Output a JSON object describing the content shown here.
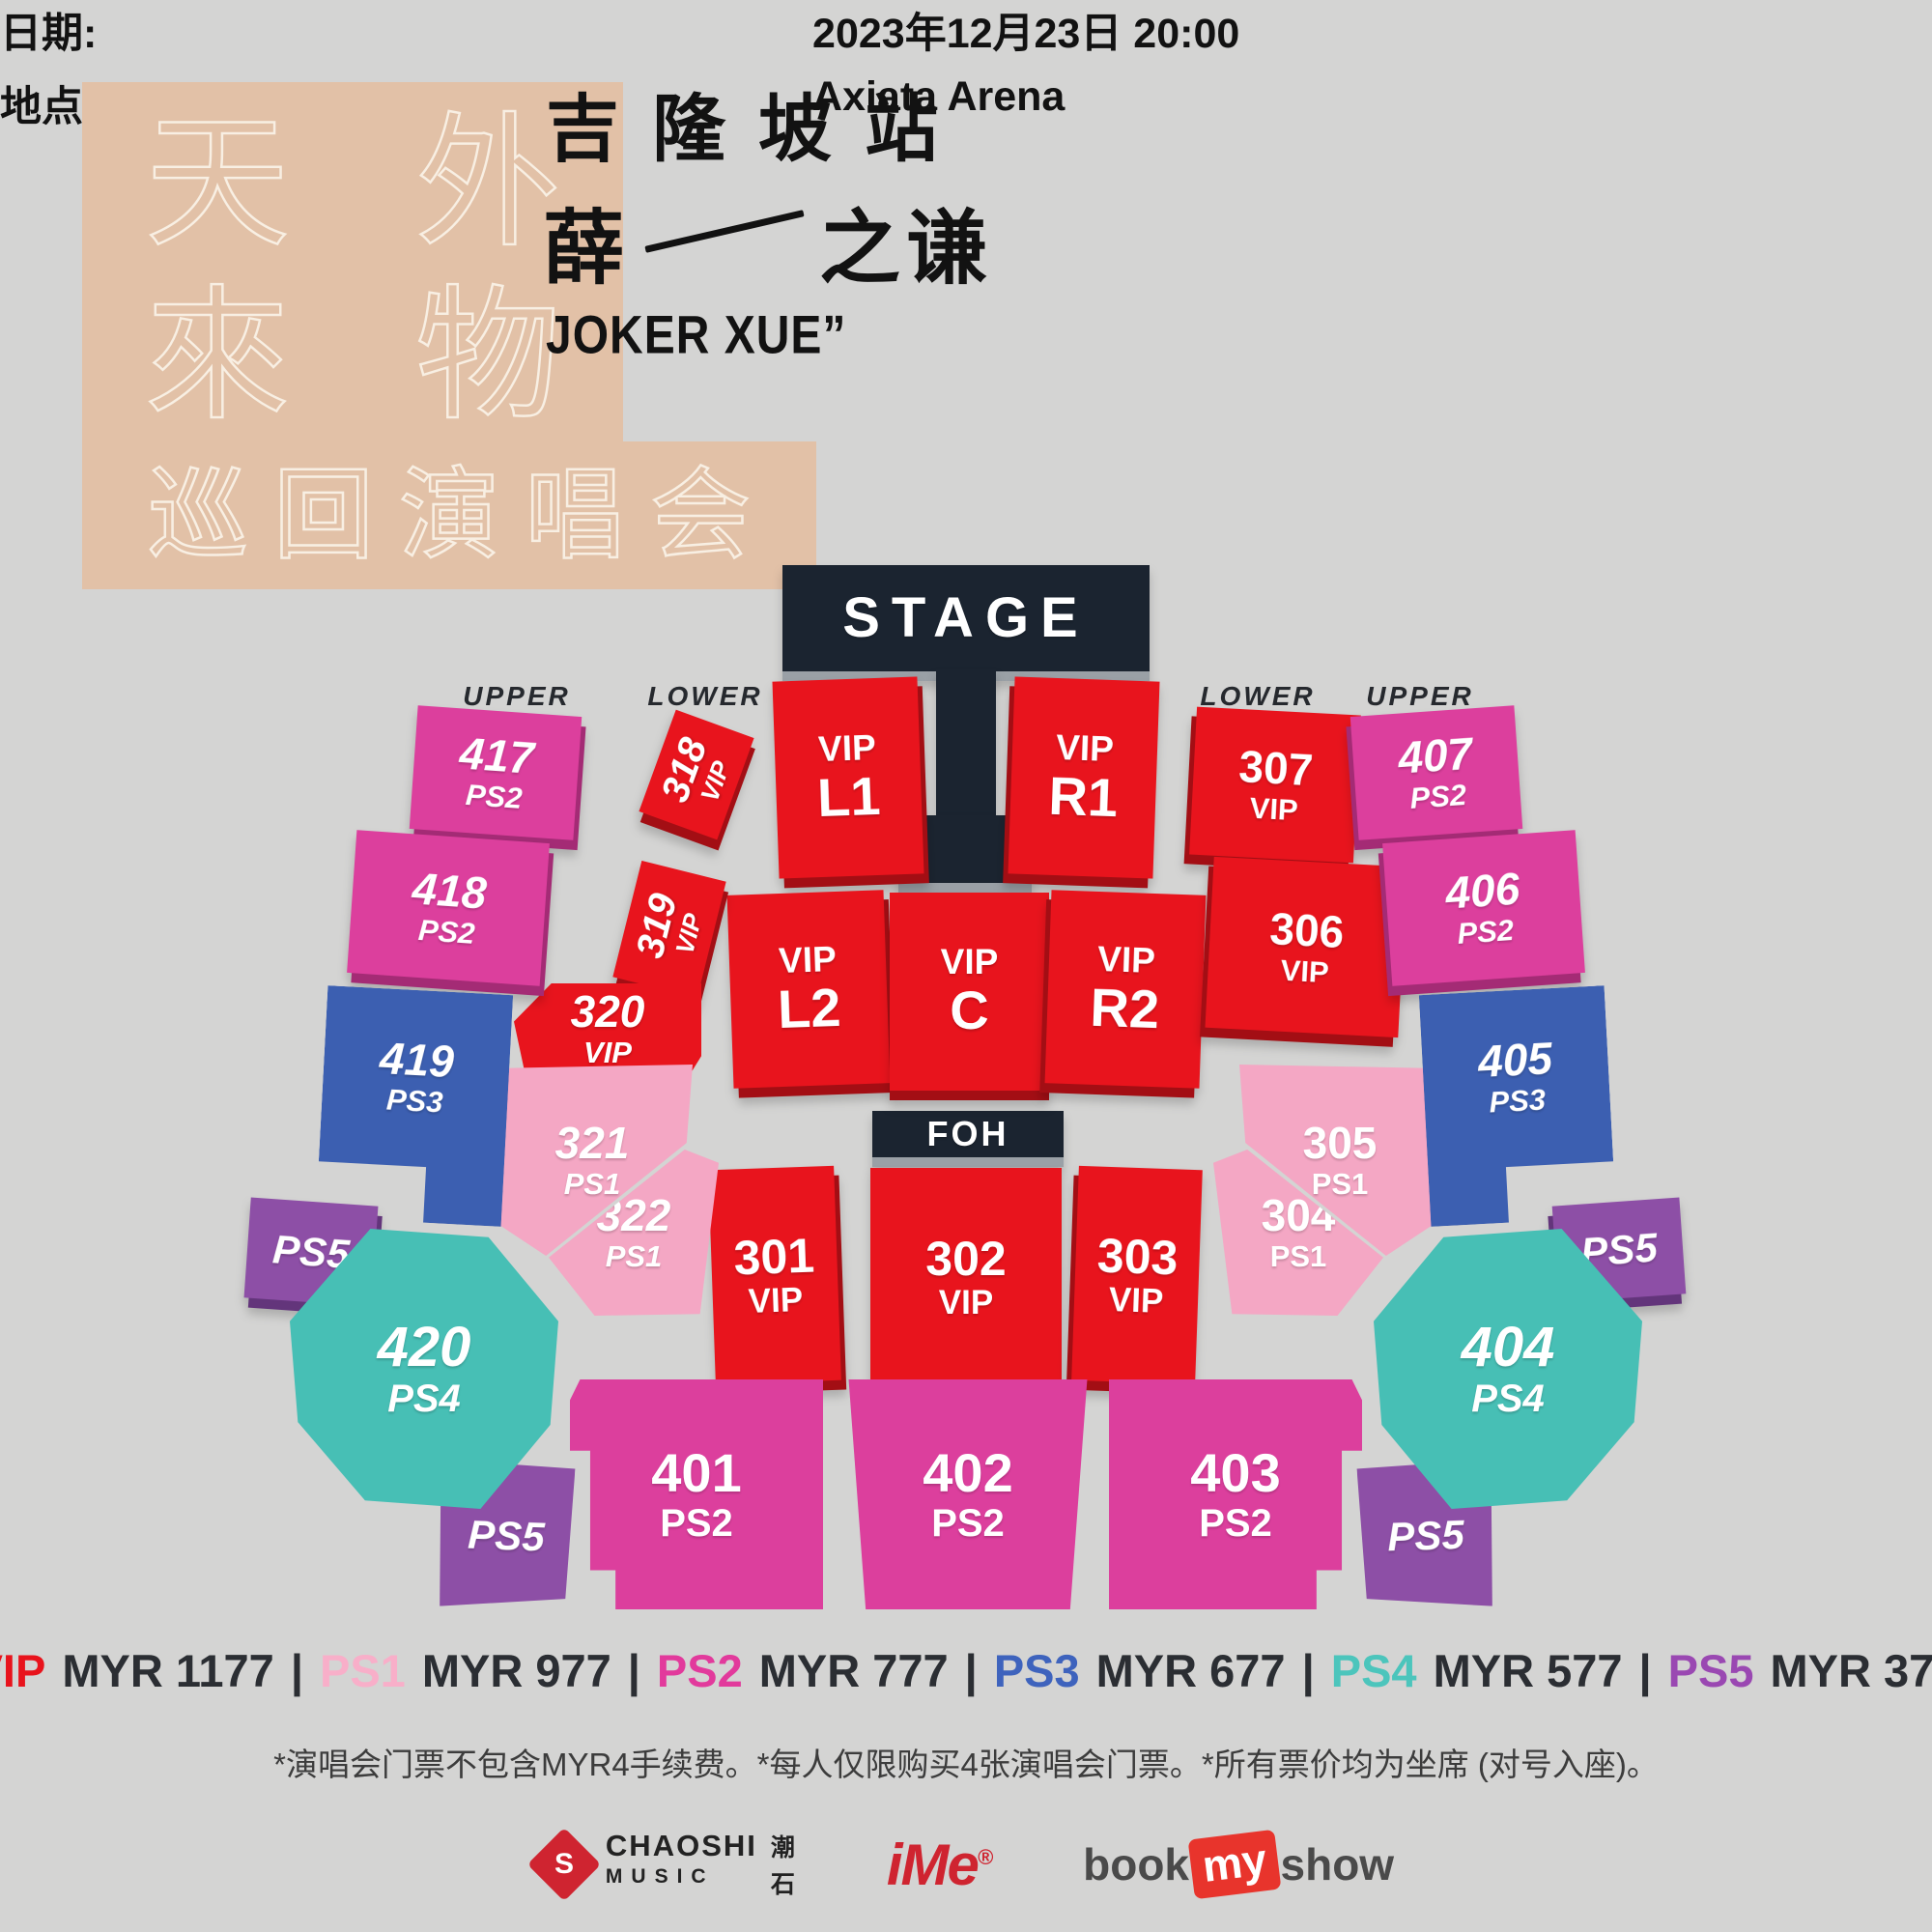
{
  "palette": {
    "bg": "#d4d4d3",
    "stage": "#1b2430",
    "vip": "#e8141d",
    "vip_d": "#a30e14",
    "ps1": "#f4a7c4",
    "ps1_d": "#c17b9b",
    "ps2": "#dc3f9d",
    "ps2_d": "#a42b75",
    "ps3": "#3c5fb1",
    "ps3_d": "#28407c",
    "ps4": "#47bfb5",
    "ps4_d": "#2f8c84",
    "ps5": "#8d4fa6",
    "ps5_d": "#63357b",
    "logo_bg": "#e2c1a7",
    "logo_tx": "#f8efe3"
  },
  "header": {
    "logo": {
      "r1c1": "天",
      "r1c2": "外",
      "r2c1": "來",
      "r2c2": "物",
      "bottom": "巡回演唱会"
    },
    "station": "吉隆坡站",
    "artist_left": "薛",
    "artist_right": "之谦",
    "english_name": "JOKER XUE”",
    "date_label": "日期:",
    "date_value": "2023年12月23日  20:00",
    "venue_label": "地点:",
    "venue_value": "Axiata Arena"
  },
  "map": {
    "stage_label": "STAGE",
    "foh_label": "FOH",
    "tier_labels": {
      "left_upper": "UPPER",
      "left_lower": "LOWER",
      "right_lower": "LOWER",
      "right_upper": "UPPER"
    },
    "sections": {
      "s417": {
        "l1": "417",
        "l2": "PS2"
      },
      "s418": {
        "l1": "418",
        "l2": "PS2"
      },
      "s419": {
        "l1": "419",
        "l2": "PS3"
      },
      "s420": {
        "l1": "420",
        "l2": "PS4"
      },
      "s318": {
        "l1": "318",
        "l2": "VIP"
      },
      "s319": {
        "l1": "319",
        "l2": "VIP"
      },
      "s320": {
        "l1": "320",
        "l2": "VIP"
      },
      "s321": {
        "l1": "321",
        "l2": "PS1"
      },
      "s322": {
        "l1": "322",
        "l2": "PS1"
      },
      "vip_l1": {
        "l1": "VIP",
        "l2": "L1"
      },
      "vip_r1": {
        "l1": "VIP",
        "l2": "R1"
      },
      "vip_l2": {
        "l1": "VIP",
        "l2": "L2"
      },
      "vip_c": {
        "l1": "VIP",
        "l2": "C"
      },
      "vip_r2": {
        "l1": "VIP",
        "l2": "R2"
      },
      "s301": {
        "l1": "301",
        "l2": "VIP"
      },
      "s302": {
        "l1": "302",
        "l2": "VIP"
      },
      "s303": {
        "l1": "303",
        "l2": "VIP"
      },
      "s304": {
        "l1": "304",
        "l2": "PS1"
      },
      "s305": {
        "l1": "305",
        "l2": "PS1"
      },
      "s306": {
        "l1": "306",
        "l2": "VIP"
      },
      "s307": {
        "l1": "307",
        "l2": "VIP"
      },
      "s401": {
        "l1": "401",
        "l2": "PS2"
      },
      "s402": {
        "l1": "402",
        "l2": "PS2"
      },
      "s403": {
        "l1": "403",
        "l2": "PS2"
      },
      "s404": {
        "l1": "404",
        "l2": "PS4"
      },
      "s405": {
        "l1": "405",
        "l2": "PS3"
      },
      "s406": {
        "l1": "406",
        "l2": "PS2"
      },
      "s407": {
        "l1": "407",
        "l2": "PS2"
      },
      "ps5_lt": {
        "l1": "PS5"
      },
      "ps5_lb": {
        "l1": "PS5"
      },
      "ps5_rt": {
        "l1": "PS5"
      },
      "ps5_rb": {
        "l1": "PS5"
      }
    }
  },
  "legend": {
    "sep": "|",
    "items": [
      {
        "key": "VIP",
        "price": "MYR 1177",
        "color": "#e8131c"
      },
      {
        "key": "PS1",
        "price": "MYR 977",
        "color": "#f8afc9"
      },
      {
        "key": "PS2",
        "price": "MYR 777",
        "color": "#e23a9c"
      },
      {
        "key": "PS3",
        "price": "MYR 677",
        "color": "#3e63bd"
      },
      {
        "key": "PS4",
        "price": "MYR 577",
        "color": "#4cc5bc"
      },
      {
        "key": "PS5",
        "price": "MYR 377",
        "color": "#9a48b2"
      }
    ]
  },
  "disclaimer": "*演唱会门票不包含MYR4手续费。*每人仅限购买4张演唱会门票。*所有票价均为坐席 (对号入座)。",
  "footer": {
    "chaoshi": {
      "mark": "S",
      "l1": "CHAOSHI",
      "l2": "MUSIC",
      "cn1": "潮",
      "cn2": "石"
    },
    "ime": {
      "text": "iMe",
      "reg": "®"
    },
    "bookmyshow": {
      "p1": "book",
      "p2": "my",
      "p3": "show"
    }
  }
}
